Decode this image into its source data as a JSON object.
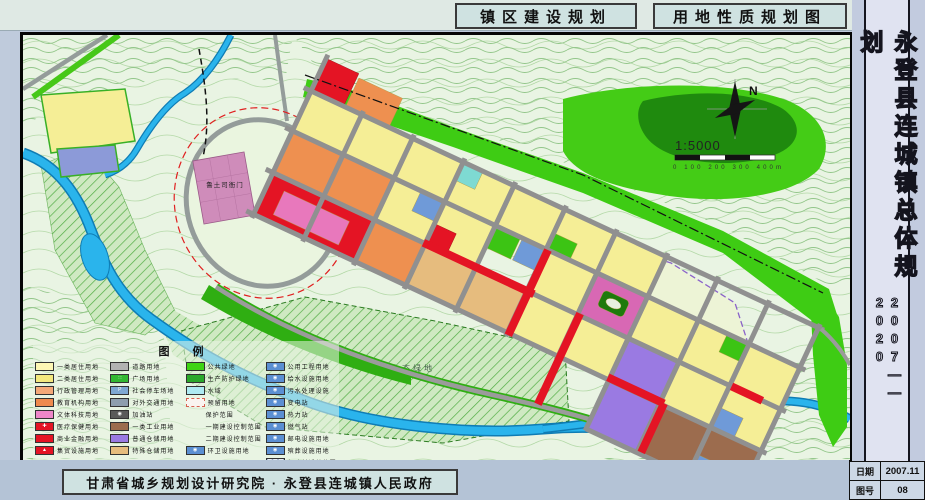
{
  "header": {
    "title_left": "镇区建设规划",
    "title_right": "用地性质规划图"
  },
  "sidebar": {
    "title": "永登县连城镇总体规划",
    "years": "2007——2020",
    "info_rows": [
      {
        "label": "日期",
        "value": "2007.11"
      },
      {
        "label": "图号",
        "value": "08"
      }
    ]
  },
  "footer": {
    "credit": "甘肃省城乡规划设计研究院 · 永登县连城镇人民政府"
  },
  "map": {
    "labels": {
      "yamen": "鲁土司衙门",
      "eco": "生态绿地",
      "north": "N",
      "scale": "1:5000",
      "scale_ticks": "0    100    200    300    400m"
    },
    "colors": {
      "water": "#2ab4ec",
      "public_green": "#3ecc14",
      "residential": "#f5ee96",
      "commercial_red": "#e41424"
    },
    "legend": {
      "title": "图    例",
      "columns": [
        [
          {
            "label": "一类居住用地",
            "kind": "fill",
            "color": "#fdf7b4"
          },
          {
            "label": "二类居住用地",
            "kind": "fill",
            "color": "#f3e87e"
          },
          {
            "label": "行政管理用地",
            "kind": "fill",
            "color": "#f4a878"
          },
          {
            "label": "教育机构用地",
            "kind": "fill",
            "color": "#ee8a4e"
          },
          {
            "label": "文体科技用地",
            "kind": "fill",
            "color": "#ee86c8"
          },
          {
            "label": "医疗保健用地",
            "kind": "fill",
            "color": "#e41424",
            "glyph": "✚",
            "icon": "medical-cross-icon"
          },
          {
            "label": "商业金融用地",
            "kind": "fill",
            "color": "#e41424"
          },
          {
            "label": "集贸设施用地",
            "kind": "fill",
            "color": "#e41424",
            "glyph": "▲",
            "icon": "market-icon"
          }
        ],
        [
          {
            "label": "道路用地",
            "kind": "fill",
            "color": "#b2b2b2"
          },
          {
            "label": "广场用地",
            "kind": "fill",
            "color": "#33b832",
            "glyph": "∷",
            "icon": "plaza-icon"
          },
          {
            "label": "社会停车场地",
            "kind": "fill",
            "color": "#7fa8d2",
            "glyph": "P",
            "icon": "parking-icon"
          },
          {
            "label": "对外交通用地",
            "kind": "fill",
            "color": "#8e9eae"
          },
          {
            "label": "加油站",
            "kind": "fill",
            "color": "#5a5a5a",
            "glyph": "◉",
            "icon": "fuel-station-icon"
          },
          {
            "label": "一类工业用地",
            "kind": "fill",
            "color": "#9c6c4e"
          },
          {
            "label": "普通仓储用地",
            "kind": "fill",
            "color": "#9a7ae2"
          },
          {
            "label": "特殊仓储用地",
            "kind": "fill",
            "color": "#e6bc7e"
          }
        ],
        [
          {
            "label": "公共绿地",
            "kind": "fill",
            "color": "#3ed414"
          },
          {
            "label": "生产防护绿地",
            "kind": "fill",
            "color": "#2aa82a"
          },
          {
            "label": "水域",
            "kind": "fill",
            "color": "#aeeaf2"
          },
          {
            "label": "预留用地",
            "kind": "dashbox",
            "color": "#d86050"
          },
          {
            "label": "保护范围",
            "kind": "line",
            "color": "#e02020"
          },
          {
            "label": "一期建设控制范围",
            "kind": "line",
            "color": "#222222"
          },
          {
            "label": "二期建设控制范围",
            "kind": "line",
            "color": "#2a5ac8"
          },
          {
            "label": "环卫设施用地",
            "kind": "fill",
            "color": "#5b8fd2",
            "glyph": "◉",
            "icon": "sanitation-icon"
          }
        ],
        [
          {
            "label": "公用工程用地",
            "kind": "fill",
            "color": "#5b8fd2",
            "glyph": "◉",
            "icon": "utility-works-icon"
          },
          {
            "label": "给水设施用地",
            "kind": "fill",
            "color": "#5b8fd2",
            "glyph": "◉",
            "icon": "water-supply-icon"
          },
          {
            "label": "污水处理设施",
            "kind": "fill",
            "color": "#5b8fd2",
            "glyph": "◉",
            "icon": "sewage-treatment-icon"
          },
          {
            "label": "变电站",
            "kind": "fill",
            "color": "#5b8fd2",
            "glyph": "◉",
            "icon": "substation-icon"
          },
          {
            "label": "热力站",
            "kind": "fill",
            "color": "#5b8fd2",
            "glyph": "◉",
            "icon": "heating-station-icon"
          },
          {
            "label": "燃气站",
            "kind": "fill",
            "color": "#5b8fd2",
            "glyph": "◉",
            "icon": "gas-station-icon"
          },
          {
            "label": "邮电设施用地",
            "kind": "fill",
            "color": "#5b8fd2",
            "glyph": "◉",
            "icon": "post-telecom-icon"
          },
          {
            "label": "殡葬设施用地",
            "kind": "fill",
            "color": "#5b8fd2",
            "glyph": "◉",
            "icon": "funeral-icon"
          },
          {
            "label": "行政村迁并范围",
            "kind": "hatch",
            "color": "#9ab0c6"
          }
        ]
      ]
    }
  }
}
